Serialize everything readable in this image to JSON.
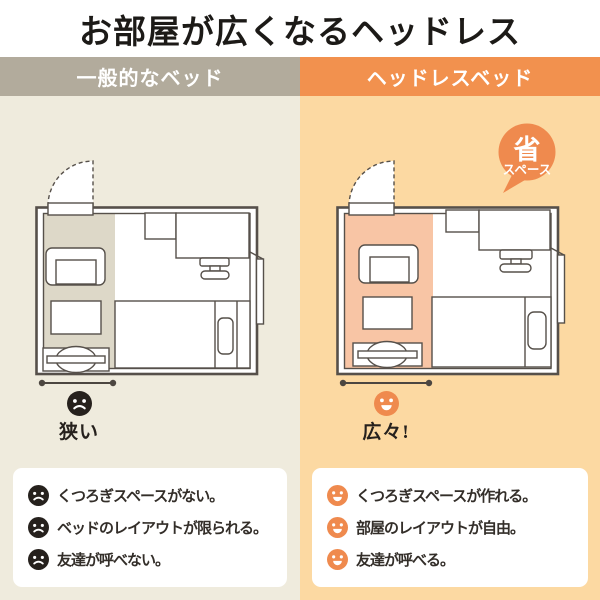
{
  "title": "お部屋が広くなるヘッドレス",
  "left": {
    "header": "一般的なベッド",
    "verdict": "狭い",
    "items": [
      "くつろぎスペースがない。",
      "ベッドのレイアウトが限られる。",
      "友達が呼べない。"
    ]
  },
  "right": {
    "header": "ヘッドレスベッド",
    "badge": {
      "line1": "省",
      "line2": "スペース"
    },
    "verdict": "広々!",
    "items": [
      "くつろぎスペースが作れる。",
      "部屋のレイアウトが自由。",
      "友達が呼べる。"
    ]
  },
  "colors": {
    "left_header_bg": "#b2ab9c",
    "right_header_bg": "#f2914e",
    "left_column_bg": "#efebdd",
    "right_column_bg": "#fcd9a2",
    "left_floor_zone": "#ddd8c8",
    "right_floor_zone": "#f8c5a5",
    "accent_orange": "#ef8a4e",
    "face_black": "#26211d",
    "plan_line": "#56504a"
  }
}
